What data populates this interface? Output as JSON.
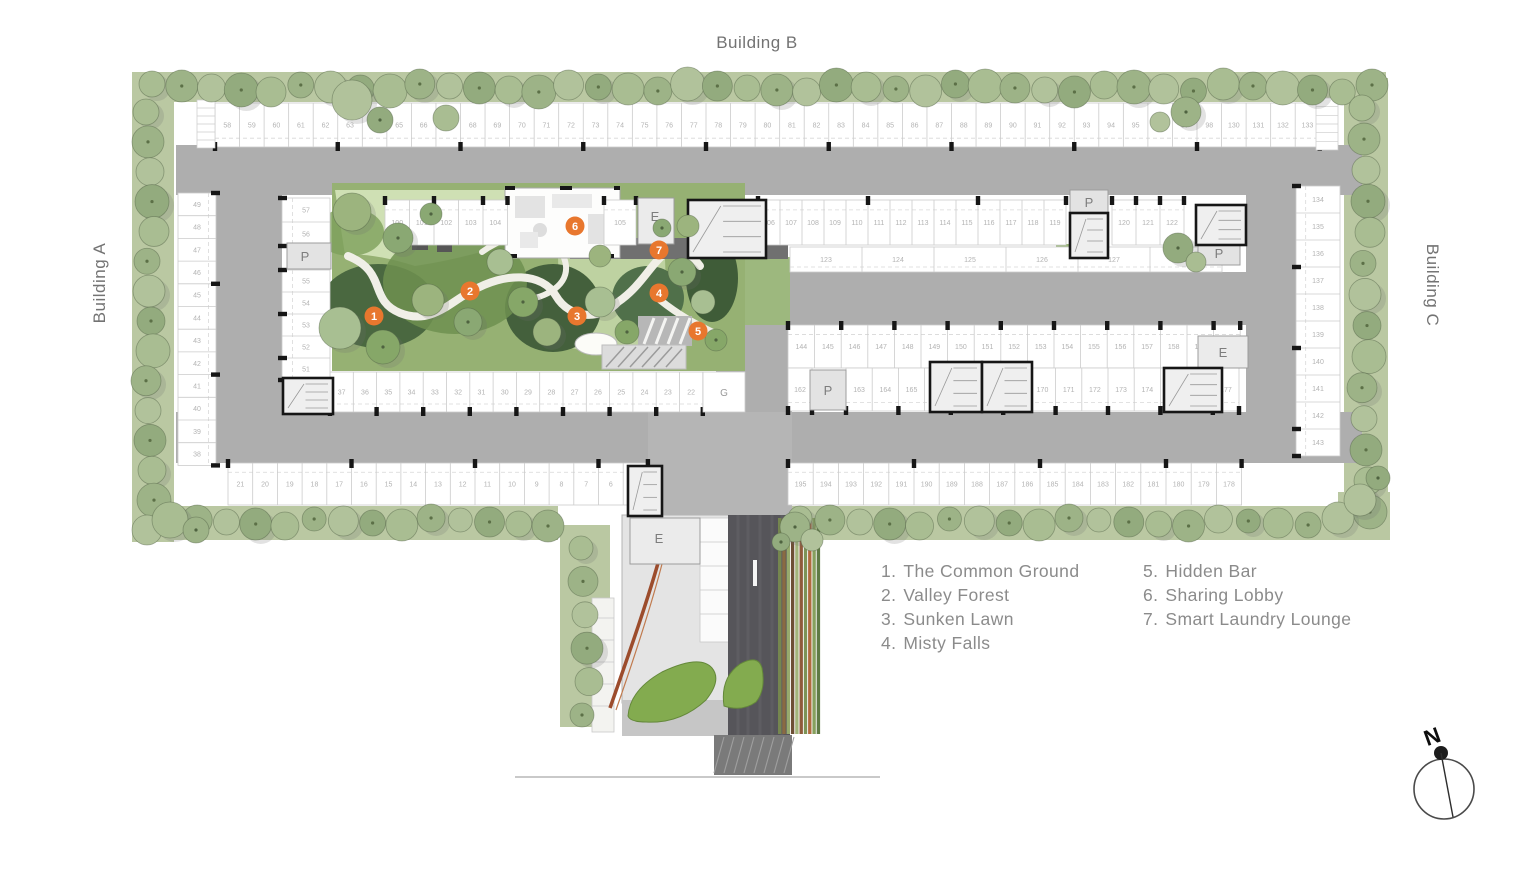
{
  "labels": {
    "top": "Building B",
    "left": "Building A",
    "right": "Building C"
  },
  "legend": {
    "col1": [
      {
        "num": "1.",
        "label": "The Common Ground"
      },
      {
        "num": "2.",
        "label": "Valley Forest"
      },
      {
        "num": "3.",
        "label": "Sunken Lawn"
      },
      {
        "num": "4.",
        "label": "Misty Falls"
      }
    ],
    "col2": [
      {
        "num": "5.",
        "label": "Hidden Bar"
      },
      {
        "num": "6.",
        "label": "Sharing Lobby"
      },
      {
        "num": "7.",
        "label": "Smart Laundry Lounge"
      }
    ]
  },
  "compass": {
    "letter": "N"
  },
  "colors": {
    "accent": "#e8772e",
    "road": "#aeaeae",
    "road_light": "#b5b5b5",
    "band": "#bac8a2",
    "stall_line": "#cbcbcb",
    "number": "#b3b3b3",
    "black": "#161616",
    "drive": "#56555a",
    "text": "#8b8b8b",
    "heading": "#737373"
  },
  "markers": [
    {
      "n": "1",
      "x": 374,
      "y": 316
    },
    {
      "n": "2",
      "x": 470,
      "y": 291
    },
    {
      "n": "3",
      "x": 577,
      "y": 316
    },
    {
      "n": "4",
      "x": 659,
      "y": 293
    },
    {
      "n": "5",
      "x": 698,
      "y": 331
    },
    {
      "n": "6",
      "x": 575,
      "y": 226
    },
    {
      "n": "7",
      "x": 659,
      "y": 250
    }
  ],
  "plan": {
    "green_strips": [
      [
        140,
        72,
        1246,
        30
      ],
      [
        132,
        72,
        42,
        470
      ],
      [
        1344,
        78,
        44,
        436
      ],
      [
        148,
        506,
        410,
        34
      ],
      [
        788,
        506,
        554,
        34
      ],
      [
        560,
        525,
        50,
        202
      ],
      [
        1338,
        492,
        52,
        48
      ]
    ],
    "roads": [
      [
        176,
        145,
        1186,
        50
      ],
      [
        176,
        412,
        1186,
        51
      ],
      [
        216,
        145,
        66,
        318
      ],
      [
        1246,
        145,
        50,
        318
      ],
      [
        740,
        272,
        506,
        53
      ],
      [
        716,
        325,
        76,
        88
      ]
    ],
    "throat": [
      648,
      412,
      144,
      103
    ],
    "green_patches": [
      [
        768,
        246,
        20,
        26
      ],
      [
        1056,
        244,
        16,
        28
      ],
      [
        745,
        257,
        45,
        68
      ]
    ],
    "parking_rows": [
      {
        "o": "h",
        "x": 215,
        "y": 103,
        "d": 44,
        "s": 24.55,
        "ticks": "bottom",
        "te": 5,
        "segs": [
          [
            58,
            98
          ],
          [
            130,
            133
          ]
        ]
      },
      {
        "o": "h",
        "x": 385,
        "y": 200,
        "d": 45,
        "s": 24.5,
        "ticks": "top",
        "te": 2,
        "segs": [
          [
            100,
            104
          ]
        ]
      },
      {
        "o": "h",
        "x": 604,
        "y": 200,
        "d": 45,
        "s": 32,
        "ticks": "top",
        "te": 1,
        "segs": [
          [
            105,
            105
          ]
        ]
      },
      {
        "o": "h",
        "x": 758,
        "y": 200,
        "d": 45,
        "s": 22,
        "ticks": "top",
        "te": 5,
        "segs": [
          [
            106,
            119
          ]
        ]
      },
      {
        "o": "h",
        "x": 1112,
        "y": 200,
        "d": 45,
        "s": 24,
        "ticks": "top",
        "te": 1,
        "segs": [
          [
            120,
            122
          ]
        ]
      },
      {
        "o": "h",
        "x": 790,
        "y": 247,
        "d": 25,
        "s": 72,
        "ticks": "none",
        "te": 0,
        "segs": [
          [
            123,
            128
          ]
        ]
      },
      {
        "o": "h",
        "x": 788,
        "y": 325,
        "d": 43,
        "s": 26.6,
        "ticks": "top",
        "te": 2,
        "segs": [
          [
            144,
            160
          ]
        ]
      },
      {
        "o": "h",
        "x": 788,
        "y": 368,
        "d": 43,
        "s": 24,
        "ticks": "bottom",
        "te": 1,
        "segs": [
          [
            162,
            162
          ]
        ]
      },
      {
        "o": "h",
        "x": 846,
        "y": 368,
        "d": 43,
        "s": 26.2,
        "ticks": "bottom",
        "te": 2,
        "segs": [
          [
            163,
            177
          ]
        ]
      },
      {
        "o": "h",
        "x": 330,
        "y": 372,
        "d": 40,
        "s": 23.3,
        "ticks": "bottom",
        "te": 2,
        "segs": [
          [
            37,
            22
          ]
        ]
      },
      {
        "o": "h",
        "x": 228,
        "y": 463,
        "d": 42,
        "s": 24.7,
        "ticks": "top",
        "te": 5,
        "segs": [
          [
            21,
            5
          ]
        ]
      },
      {
        "o": "h",
        "x": 788,
        "y": 463,
        "d": 42,
        "s": 25.2,
        "ticks": "top",
        "te": 5,
        "segs": [
          [
            195,
            178
          ]
        ]
      },
      {
        "o": "v",
        "x": 178,
        "y": 193,
        "d": 38,
        "s": 22.7,
        "ticks": "right",
        "te": 4,
        "segs": [
          [
            49,
            38
          ]
        ]
      },
      {
        "o": "v",
        "x": 282,
        "y": 198,
        "d": 48,
        "s": 24,
        "ticks": "left",
        "te": 2,
        "segs": [
          [
            57,
            56
          ]
        ]
      },
      {
        "o": "v",
        "x": 282,
        "y": 270,
        "d": 48,
        "s": 22,
        "ticks": "left",
        "te": 2,
        "segs": [
          [
            55,
            51
          ]
        ]
      },
      {
        "o": "v",
        "x": 1296,
        "y": 186,
        "d": 44,
        "s": 27,
        "ticks": "left",
        "te": 3,
        "segs": [
          [
            134,
            143
          ]
        ]
      }
    ],
    "extra_stalls": [
      [
        703,
        372,
        42,
        40
      ]
    ],
    "unnumbered_strips": [
      {
        "x": 197,
        "y": 100,
        "w": 18,
        "h": 48,
        "n": 6
      },
      {
        "x": 1316,
        "y": 98,
        "w": 22,
        "h": 52,
        "n": 6
      }
    ],
    "cores": [
      [
        283,
        378,
        50,
        36
      ],
      [
        1070,
        213,
        38,
        45
      ],
      [
        1196,
        205,
        50,
        40
      ],
      [
        930,
        362,
        52,
        50
      ],
      [
        982,
        362,
        50,
        50
      ],
      [
        1164,
        368,
        58,
        44
      ],
      [
        628,
        466,
        34,
        50
      ],
      [
        688,
        200,
        78,
        58
      ]
    ],
    "p_boxes": [
      [
        287,
        243,
        44,
        26
      ],
      [
        1070,
        190,
        38,
        24
      ],
      [
        1198,
        241,
        42,
        24
      ],
      [
        810,
        370,
        36,
        40
      ]
    ],
    "e_rooms": [
      [
        638,
        198,
        36,
        46
      ],
      [
        1198,
        336,
        50,
        32
      ],
      [
        630,
        518,
        70,
        46
      ]
    ],
    "room_labels": [
      {
        "t": "E",
        "x": 655,
        "y": 221
      },
      {
        "t": "E",
        "x": 1223,
        "y": 357
      },
      {
        "t": "E",
        "x": 659,
        "y": 543
      },
      {
        "t": "P",
        "x": 305,
        "y": 261
      },
      {
        "t": "P",
        "x": 1089,
        "y": 207
      },
      {
        "t": "P",
        "x": 1219,
        "y": 258
      },
      {
        "t": "P",
        "x": 828,
        "y": 395
      },
      {
        "t": "G",
        "x": 724,
        "y": 396
      }
    ],
    "tree_bands": [
      [
        152,
        88,
        1372,
        88,
        42,
        15
      ],
      [
        150,
        112,
        150,
        530,
        15,
        15
      ],
      [
        1366,
        108,
        1366,
        512,
        14,
        15
      ],
      [
        168,
        522,
        548,
        522,
        14,
        14
      ],
      [
        800,
        522,
        1338,
        522,
        19,
        14
      ],
      [
        585,
        548,
        585,
        715,
        6,
        14
      ]
    ],
    "tree_singles": [
      [
        352,
        212,
        19,
        0
      ],
      [
        398,
        238,
        15,
        0
      ],
      [
        340,
        328,
        21,
        0
      ],
      [
        383,
        347,
        17,
        0
      ],
      [
        428,
        300,
        16,
        0
      ],
      [
        468,
        322,
        14,
        0
      ],
      [
        500,
        262,
        13,
        0
      ],
      [
        523,
        302,
        15,
        0
      ],
      [
        547,
        332,
        14,
        0
      ],
      [
        431,
        214,
        11,
        0
      ],
      [
        600,
        302,
        15,
        0
      ],
      [
        627,
        332,
        12,
        0
      ],
      [
        600,
        256,
        11,
        0
      ],
      [
        682,
        272,
        14,
        0
      ],
      [
        703,
        302,
        12,
        0
      ],
      [
        716,
        340,
        11,
        0
      ],
      [
        688,
        226,
        11,
        0
      ],
      [
        662,
        228,
        9,
        0
      ],
      [
        352,
        100,
        20,
        1
      ],
      [
        380,
        120,
        13,
        1
      ],
      [
        446,
        118,
        13,
        1
      ],
      [
        1186,
        112,
        15,
        1
      ],
      [
        1160,
        122,
        10,
        1
      ],
      [
        1178,
        248,
        15,
        1
      ],
      [
        1196,
        262,
        10,
        1
      ],
      [
        795,
        527,
        15,
        1
      ],
      [
        812,
        540,
        11,
        1
      ],
      [
        781,
        542,
        9,
        1
      ],
      [
        170,
        520,
        18,
        1
      ],
      [
        196,
        530,
        13,
        1
      ],
      [
        1360,
        500,
        16,
        1
      ],
      [
        1378,
        478,
        12,
        1
      ]
    ],
    "tree_palette": [
      "#a9bd92",
      "#9db387",
      "#b1c29b",
      "#93ab7e"
    ],
    "garden_tree_palette": [
      "#9cb47e",
      "#8aa873",
      "#a8bf92",
      "#86a768"
    ],
    "stripe_colors": [
      "#75864f",
      "#8a6a42",
      "#97aa6d",
      "#6d4f35",
      "#a3b47b",
      "#8f5b3b",
      "#7d9457",
      "#b06a3e",
      "#86a05e",
      "#5f7a45"
    ]
  }
}
